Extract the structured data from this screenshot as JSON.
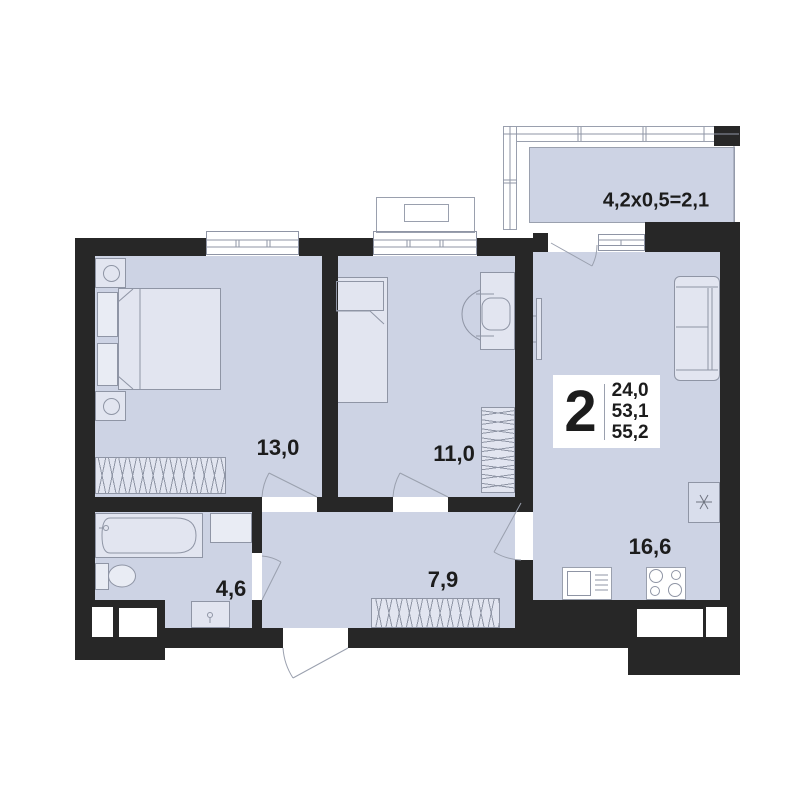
{
  "colors": {
    "wall": "#272727",
    "floor": "#cdd3e4",
    "furniture": "#e2e5f0",
    "line": "#8f95a5",
    "text": "#1c1c1c"
  },
  "apartment_card": {
    "rooms_count": "2",
    "areas": [
      "24,0",
      "53,1",
      "55,2"
    ]
  },
  "room_labels": {
    "bedroom": "13,0",
    "child_room": "11,0",
    "kitchen_living": "16,6",
    "hallway": "7,9",
    "bathroom": "4,6",
    "balcony": "4,2x0,5=2,1"
  }
}
